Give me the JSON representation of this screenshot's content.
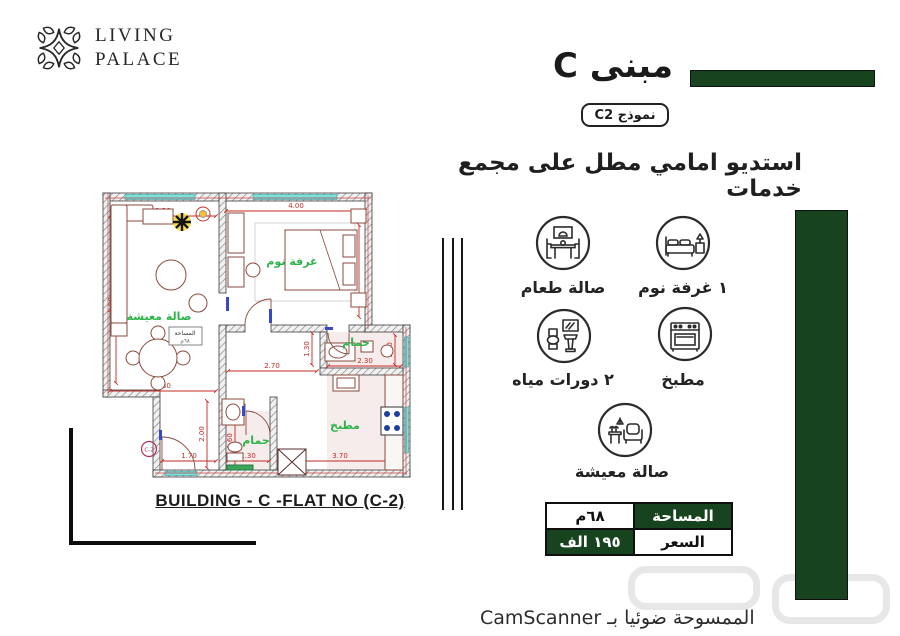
{
  "brand": {
    "line1": "LIVING",
    "line2": "PALACE"
  },
  "header": {
    "title": "مبنى C",
    "model": "نموذج C2",
    "subtitle": "استديو امامي مطل على مجمع خدمات"
  },
  "plan": {
    "caption": "BUILDING - C -FLAT NO (C-2)",
    "unit": "C-2",
    "labels": {
      "living": "صالة معيشة",
      "bedroom": "غرفة نوم",
      "bath_top": "حمام",
      "bath_bottom": "حمام",
      "kitchen": "مطبخ"
    },
    "stamp": {
      "title": "المساحة",
      "value": "٦٨م"
    },
    "dims": {
      "living_top": "3.30",
      "bedroom_top": "4.00",
      "living_left": "5.50",
      "bedroom_right": "3.70",
      "hall_v": "1.30",
      "hall_h": "2.70",
      "bath_top_w": "2.30",
      "bath_top_h": "1.30",
      "living_bottom": "3.30",
      "entry_v": "2.00",
      "bath_bottom_v": "1.60",
      "entry_w": "1.70",
      "bath_bottom_w": "1.30",
      "kitchen_w": "3.70",
      "kitchen_h": "2.70"
    }
  },
  "features": [
    {
      "icon": "dining-icon",
      "label": "صالة طعام"
    },
    {
      "icon": "bed-icon",
      "label": "١ غرفة نوم"
    },
    {
      "icon": "toilet-icon",
      "label": "٢ دورات مياه"
    },
    {
      "icon": "stove-icon",
      "label": "مطبخ"
    },
    {
      "icon": "sofa-icon",
      "label": "صالة معيشة"
    }
  ],
  "summary": {
    "area_label": "المساحة",
    "area_value": "٦٨م",
    "price_label": "السعر",
    "price_value": "١٩٥ الف"
  },
  "footer": {
    "scanned": "الممسوحة ضوئيا بـ CamScanner"
  },
  "colors": {
    "dark_green": "#17441f",
    "room_label_green": "#2db34a",
    "dimension_red": "#c42823",
    "window_teal": "#79e2df"
  }
}
